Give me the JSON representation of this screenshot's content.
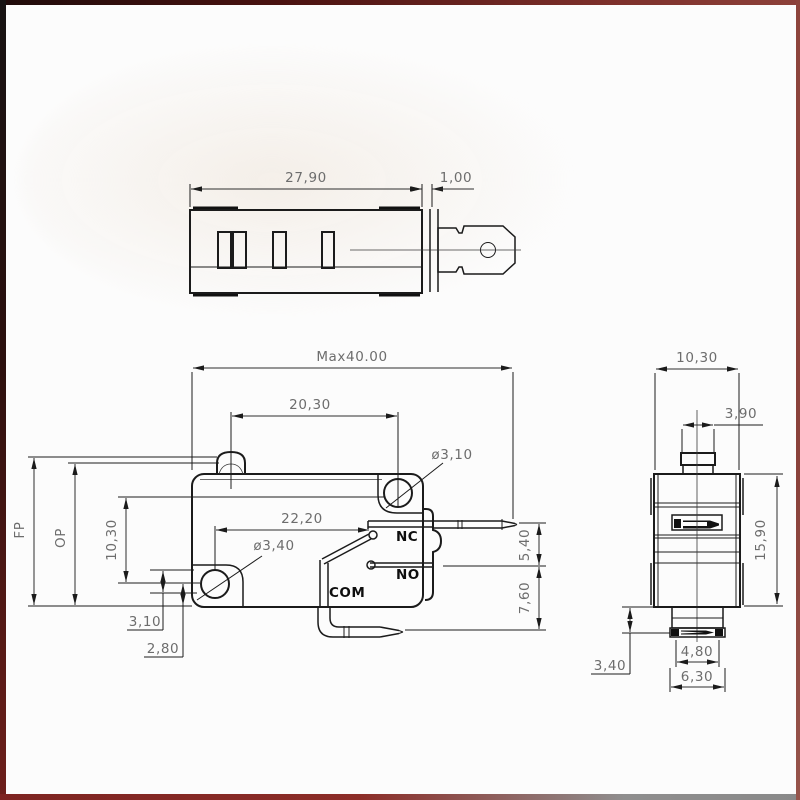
{
  "title": "Micro switch three-view technical drawing",
  "palette": {
    "background": "#fcfcfc",
    "line": "#1b1b1b",
    "dimension_text": "#6d6d6d",
    "frame_red": "#7c2f2a",
    "frame_gray": "#8f8e8e"
  },
  "top_view": {
    "dim_body_length": "27,90",
    "dim_plate_thickness": "1,00"
  },
  "front_view": {
    "dim_max_length": "Max40.00",
    "dim_plunger_to_hole": "20,30",
    "dim_contact_span": "22,20",
    "dim_hole_top": "ø3,10",
    "dim_hole_bottom": "ø3,40",
    "label_free_position": "FP",
    "label_operating_position": "OP",
    "dim_hole_spacing": "10,30",
    "dim_step": "3,10",
    "dim_hole_to_edge": "2,80",
    "dim_terminal_offset": "5,40",
    "dim_com_terminal_offset": "7,60",
    "label_nc": "NC",
    "label_no": "NO",
    "label_com": "COM"
  },
  "side_view": {
    "dim_width": "10,30",
    "dim_plunger_width": "3,90",
    "dim_height": "15,90",
    "dim_base_height": "3,40",
    "dim_base_inner_width": "4,80",
    "dim_base_outer_width": "6,30"
  }
}
